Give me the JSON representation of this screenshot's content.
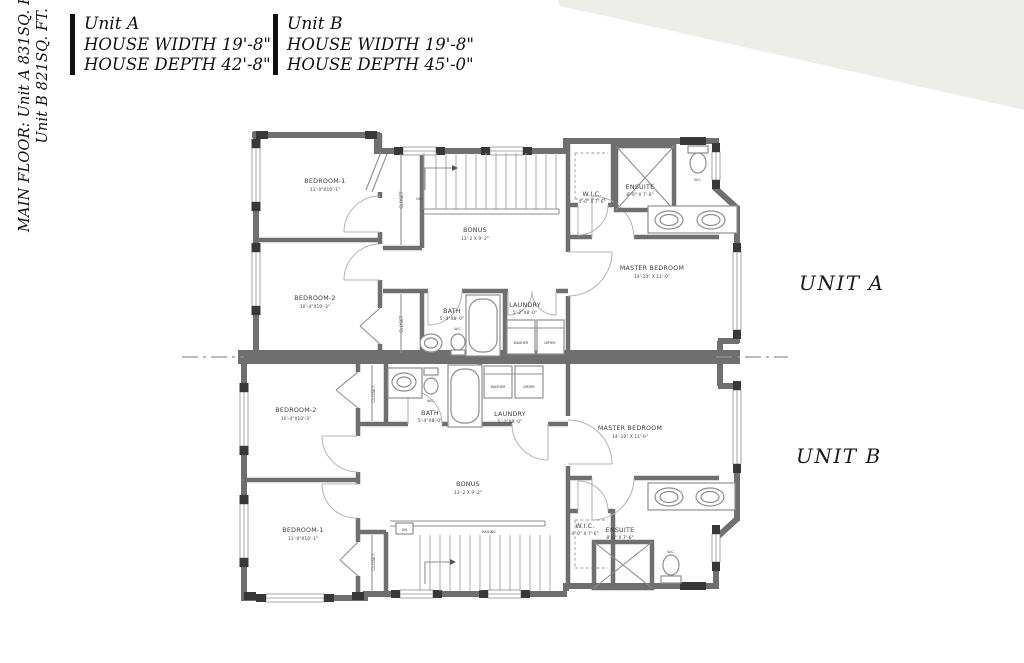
{
  "side_note": {
    "line1": "MAIN FLOOR: Unit A 831SQ. FT.",
    "line2": "Unit B 821SQ. FT."
  },
  "header": {
    "unit_a": {
      "title": "Unit A",
      "width_line": "HOUSE WIDTH 19'-8\"",
      "depth_line": "HOUSE DEPTH  42'-8\""
    },
    "unit_b": {
      "title": "Unit B",
      "width_line": "HOUSE WIDTH 19'-8\"",
      "depth_line": "HOUSE DEPTH  45'-0\""
    }
  },
  "plan_labels": {
    "unit_a": "UNIT A",
    "unit_b": "UNIT B"
  },
  "rooms": {
    "unit_a": {
      "bedroom1": {
        "name": "BEDROOM-1",
        "dims": "11'-0\"X10'-1\""
      },
      "bedroom2": {
        "name": "BEDROOM-2",
        "dims": "10'-4\"X10'-3\""
      },
      "bonus": {
        "name": "BONUS",
        "dims": "13'-2 X 9'-2\""
      },
      "bath": {
        "name": "BATH",
        "dims": "5'-4\"X8'-0\""
      },
      "laundry": {
        "name": "LAUNDRY",
        "dims": "5'-2\"X8'-0\""
      },
      "wic": {
        "name": "W.I.C.",
        "dims": "4'-0\" X 7'-6\""
      },
      "ensuite": {
        "name": "ENSUITE",
        "dims": "8'-6\" X 7'-6\""
      },
      "master": {
        "name": "MASTER BEDROOM",
        "dims": "14'-10\" X 11'-0\""
      }
    },
    "unit_b": {
      "bedroom1": {
        "name": "BEDROOM-1",
        "dims": "11'-0\"X10'-1\""
      },
      "bedroom2": {
        "name": "BEDROOM-2",
        "dims": "10'-4\"X10'-3\""
      },
      "bonus": {
        "name": "BONUS",
        "dims": "13'-2 X 9'-2\""
      },
      "bath": {
        "name": "BATH",
        "dims": "5'-4\"X8'-0\""
      },
      "laundry": {
        "name": "LAUNDRY",
        "dims": "5'-2\"X8'-0\""
      },
      "wic": {
        "name": "W.I.C.",
        "dims": "4'-0\" X 7'-6\""
      },
      "ensuite": {
        "name": "ENSUITE",
        "dims": "8'-6\" X 7'-6\""
      },
      "master": {
        "name": "MASTER BEDROOM",
        "dims": "14'-10\" X 11'-0\""
      }
    }
  },
  "fixtures": {
    "washer": "WASHER",
    "dryer": "DRYER",
    "wc": "W.C.",
    "closet": "CLOSET",
    "railing": "RAILING",
    "down": "DN"
  },
  "colors": {
    "wall": "#6f6f6f",
    "window_frame": "#383838",
    "fixture_line": "#8f8f8f",
    "label_text": "#3c3c3c",
    "background": "#ffffff"
  }
}
